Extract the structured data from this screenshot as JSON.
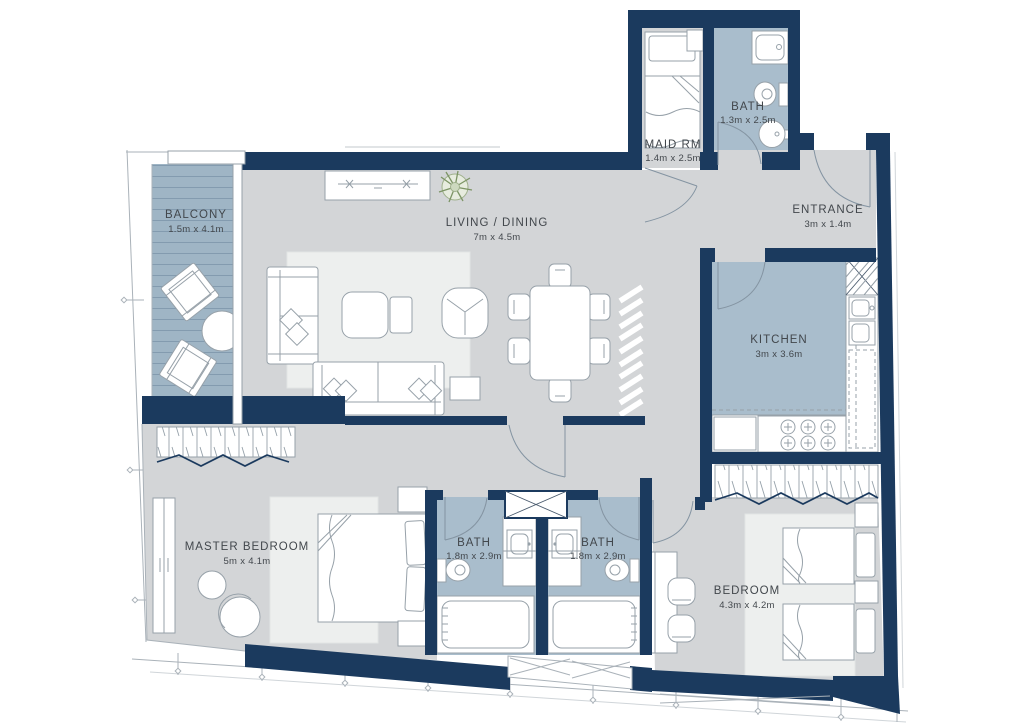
{
  "plan": {
    "colors": {
      "wall": "#1b3a5e",
      "floor": "#d3d5d7",
      "wet": "#a9bdcc",
      "balcony": "#9fb5c5",
      "rug": "#edefee",
      "furn_line": "#97a1a9",
      "door_line": "#8494a2",
      "grid_line": "#aab2b9",
      "text": "#42474c",
      "plant": "#7c9465"
    },
    "rooms": {
      "balcony": {
        "name": "BALCONY",
        "dims": "1.5m x 4.1m"
      },
      "living_dining": {
        "name": "LIVING / DINING",
        "dims": "7m x 4.5m"
      },
      "maid_room": {
        "name": "MAID RM",
        "dims": "1.4m x 2.5m"
      },
      "maid_bath": {
        "name": "BATH",
        "dims": "1.3m x 2.5m"
      },
      "entrance": {
        "name": "ENTRANCE",
        "dims": "3m x 1.4m"
      },
      "kitchen": {
        "name": "KITCHEN",
        "dims": "3m x 3.6m"
      },
      "master_bedroom": {
        "name": "MASTER BEDROOM",
        "dims": "5m x 4.1m"
      },
      "master_bath": {
        "name": "BATH",
        "dims": "1.8m x 2.9m"
      },
      "shared_bath": {
        "name": "BATH",
        "dims": "1.8m x 2.9m"
      },
      "bedroom": {
        "name": "BEDROOM",
        "dims": "4.3m x 4.2m"
      }
    }
  }
}
